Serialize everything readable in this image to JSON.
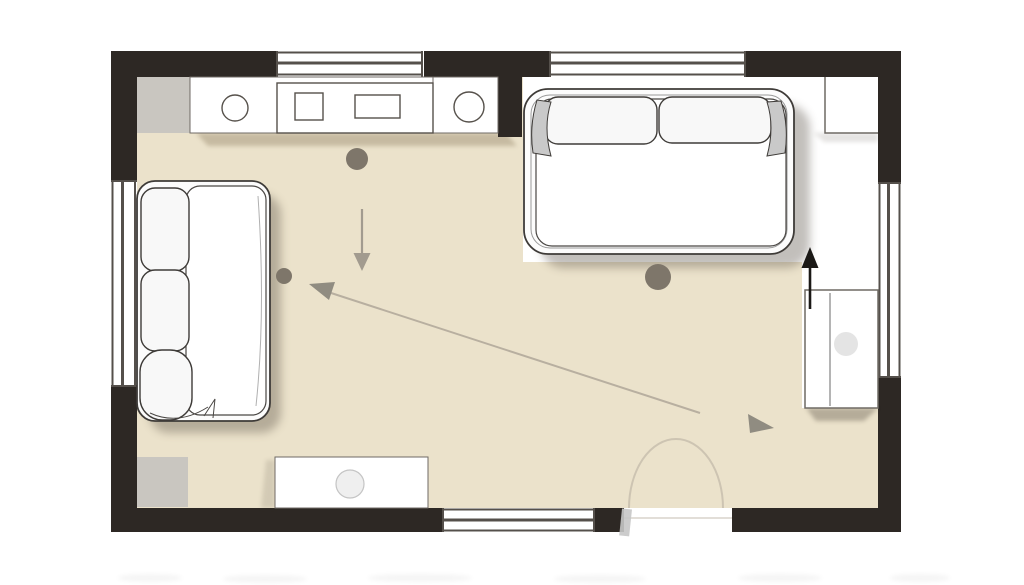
{
  "canvas": {
    "width": 1024,
    "height": 585
  },
  "colors": {
    "wall": "#2d2824",
    "floor": "#ebe2cb",
    "white_zone": "#ffffff",
    "unit_gray": "#c9c6c0",
    "armrest_gray": "#c9c9c9",
    "dot": "#7e766a",
    "arrow_gray": "#a29b8f",
    "sightline": "#b8afa0",
    "sightline_head": "#908c81",
    "black_arrow": "#1b1916",
    "window_line": "#55504b",
    "door_arc": "#cdc4b2",
    "door_leaf": "#c7c7c7",
    "table_circle": "#efefef",
    "cabinet_circle": "#e4e4e4"
  },
  "plan_items": [
    "exterior-walls",
    "window-top-left",
    "window-top-right",
    "window-left",
    "window-right",
    "window-bottom",
    "entry-door-opening",
    "door-swing-arc",
    "kitchen-corner-unit",
    "kitchen-counter",
    "sink-left",
    "sink-right",
    "cooktop-unit",
    "sofa-top-right",
    "sofa-left",
    "side-table-bottom",
    "corner-unit-bottom-left",
    "sideboard-right",
    "wall-cabinet-top-right",
    "placement-dot-1",
    "placement-dot-2",
    "placement-dot-3",
    "flow-arrow-down",
    "view-line-diagonal",
    "flow-triangle-right",
    "flow-arrow-up-black"
  ]
}
